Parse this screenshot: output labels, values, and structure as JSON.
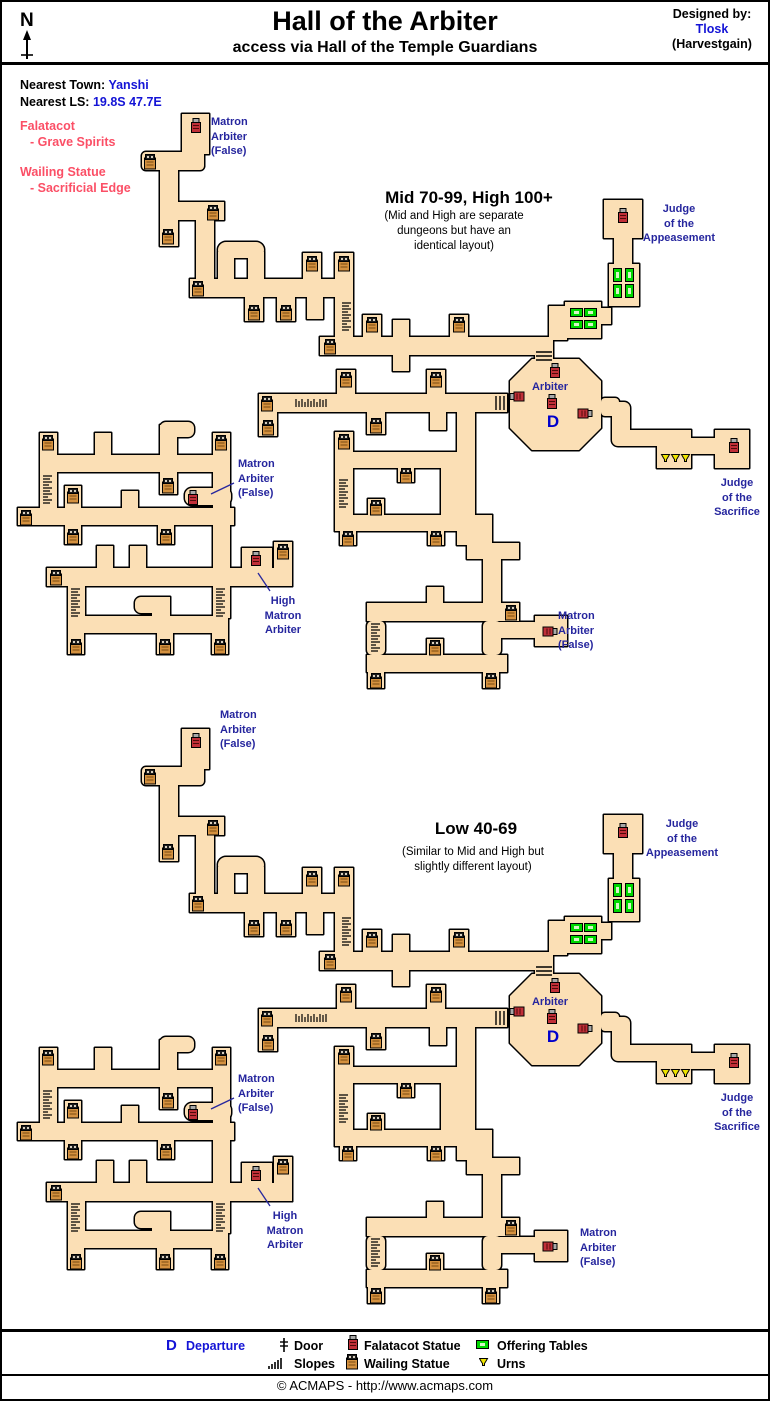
{
  "header": {
    "compass": "N",
    "title": "Hall of the Arbiter",
    "subtitle": "access via Hall of the Temple Guardians",
    "designed_by": "Designed by:",
    "designer": "Tlosk",
    "designer_world": "(Harvestgain)"
  },
  "info": {
    "town_label": "Nearest Town:",
    "town": "Yanshi",
    "ls_label": "Nearest LS:",
    "ls": "19.8S 47.7E"
  },
  "notes": {
    "falatacot_title": "Falatacot",
    "falatacot_sub": "- Grave Spirits",
    "wailing_title": "Wailing Statue",
    "wailing_sub": "- Sacrificial Edge"
  },
  "maps": {
    "upper": {
      "title": "Mid 70-99, High 100+",
      "note": [
        "(Mid and High are separate",
        "dungeons but have an",
        "identical layout)"
      ]
    },
    "lower": {
      "title": "Low 40-69",
      "note": [
        "(Similar to Mid and High but",
        "slightly different layout)"
      ]
    }
  },
  "labels": {
    "matron_false": [
      "Matron",
      "Arbiter",
      "(False)"
    ],
    "high_matron": [
      "High",
      "Matron",
      "Arbiter"
    ],
    "judge_appeasement": [
      "Judge",
      "of the",
      "Appeasement"
    ],
    "judge_sacrifice": [
      "Judge",
      "of the",
      "Sacrifice"
    ],
    "arbiter": "Arbiter",
    "departure": "D"
  },
  "legend": {
    "departure_symbol": "D",
    "departure": "Departure",
    "door": "Door",
    "slopes": "Slopes",
    "falatacot_statue": "Falatacot Statue",
    "wailing_statue": "Wailing Statue",
    "offering_tables": "Offering Tables",
    "urns": "Urns"
  },
  "footer": {
    "copyright": "© ACMAPS - http://www.acmaps.com"
  },
  "colors": {
    "corridor": "#FBDFB5",
    "outline": "#000000",
    "label_blue": "#26269E",
    "link_blue": "#1414D6",
    "departure_blue": "#0000CC",
    "note_red": "#FB4F66",
    "table_green": "#00D800",
    "urn_yellow": "#EFE400"
  }
}
